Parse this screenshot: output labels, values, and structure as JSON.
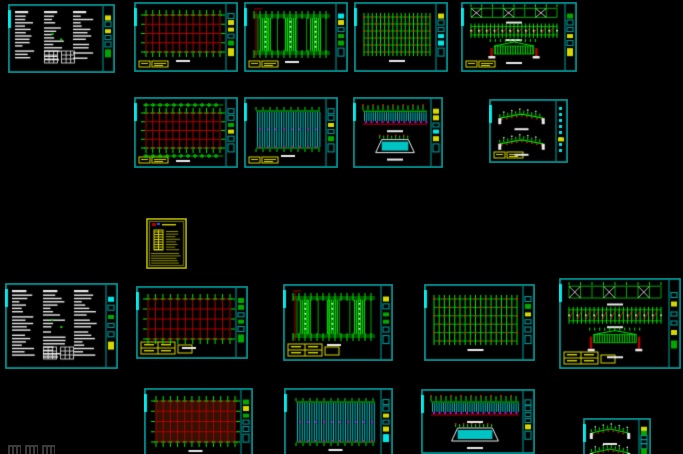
{
  "canvas": {
    "width": 683,
    "height": 454,
    "background": "#000000"
  },
  "palette": {
    "frame": "#00a6a6",
    "frameBright": "#00e8e8",
    "red": "#b40000",
    "redBright": "#e81414",
    "green": "#00a800",
    "greenBright": "#00e800",
    "yellow": "#d8d800",
    "yellowDim": "#8f8f00",
    "white": "#ececec",
    "cyanFill": "#00c4c4",
    "magenta": "#d800d8",
    "maroonFill": "#331104",
    "blue": "#3355ff",
    "watermarkGray": "#3a3a3a"
  },
  "watermark": {
    "glyph_count": 3
  },
  "sheets": [
    {
      "id": "general-notes-1",
      "kind": "notes",
      "x": 8,
      "y": 4,
      "w": 107,
      "h": 69,
      "cols": 3,
      "tables": true
    },
    {
      "id": "foundation-plan-1",
      "kind": "redgrid",
      "x": 134,
      "y": 2,
      "w": 104,
      "h": 70,
      "bl": "small"
    },
    {
      "id": "roof-framing-plan-1",
      "kind": "colplan",
      "x": 244,
      "y": 2,
      "w": 104,
      "h": 70,
      "bl": "small",
      "clusters": 3
    },
    {
      "id": "purlin-plan-1",
      "kind": "purlin",
      "x": 354,
      "y": 2,
      "w": 94,
      "h": 70
    },
    {
      "id": "elevation-sheet-1",
      "kind": "elev3",
      "x": 461,
      "y": 2,
      "w": 116,
      "h": 70,
      "bl": "small"
    },
    {
      "id": "column-grid-plan",
      "kind": "redgrid",
      "x": 134,
      "y": 97,
      "w": 104,
      "h": 71,
      "bands": true,
      "bl": "small"
    },
    {
      "id": "roof-sheeting-plan-1",
      "kind": "sheethatch",
      "x": 244,
      "y": 97,
      "w": 94,
      "h": 71,
      "bl": "small"
    },
    {
      "id": "wall-elevation-1",
      "kind": "elevhatch",
      "x": 353,
      "y": 97,
      "w": 90,
      "h": 71
    },
    {
      "id": "frame-sections-1",
      "kind": "sections2",
      "x": 489,
      "y": 99,
      "w": 79,
      "h": 64,
      "bl": "small",
      "glyphstrip": true
    },
    {
      "id": "detail-sheet-yellow",
      "kind": "yellowsheet",
      "x": 146,
      "y": 218,
      "w": 41,
      "h": 51
    },
    {
      "id": "general-notes-2",
      "kind": "notes",
      "x": 5,
      "y": 283,
      "w": 113,
      "h": 86,
      "cols": 3,
      "tables": true
    },
    {
      "id": "foundation-plan-2",
      "kind": "redgrid",
      "x": 136,
      "y": 286,
      "w": 112,
      "h": 73,
      "bl": "wide"
    },
    {
      "id": "roof-framing-plan-2",
      "kind": "colplan",
      "x": 283,
      "y": 284,
      "w": 110,
      "h": 77,
      "bl": "wide",
      "clusters": 3
    },
    {
      "id": "purlin-plan-2",
      "kind": "purlin",
      "x": 424,
      "y": 284,
      "w": 111,
      "h": 77
    },
    {
      "id": "elevation-sheet-2",
      "kind": "elev3",
      "x": 559,
      "y": 278,
      "w": 122,
      "h": 91,
      "bl": "wide"
    },
    {
      "id": "floor-grid-filled",
      "kind": "redgrid",
      "x": 144,
      "y": 388,
      "w": 109,
      "h": 70,
      "fill": true
    },
    {
      "id": "roof-sheeting-plan-2",
      "kind": "sheethatch",
      "x": 284,
      "y": 388,
      "w": 109,
      "h": 70
    },
    {
      "id": "wall-elevation-2",
      "kind": "elevhatch",
      "x": 421,
      "y": 389,
      "w": 114,
      "h": 65
    },
    {
      "id": "frame-sections-2",
      "kind": "sections2",
      "x": 583,
      "y": 418,
      "w": 68,
      "h": 50
    }
  ]
}
